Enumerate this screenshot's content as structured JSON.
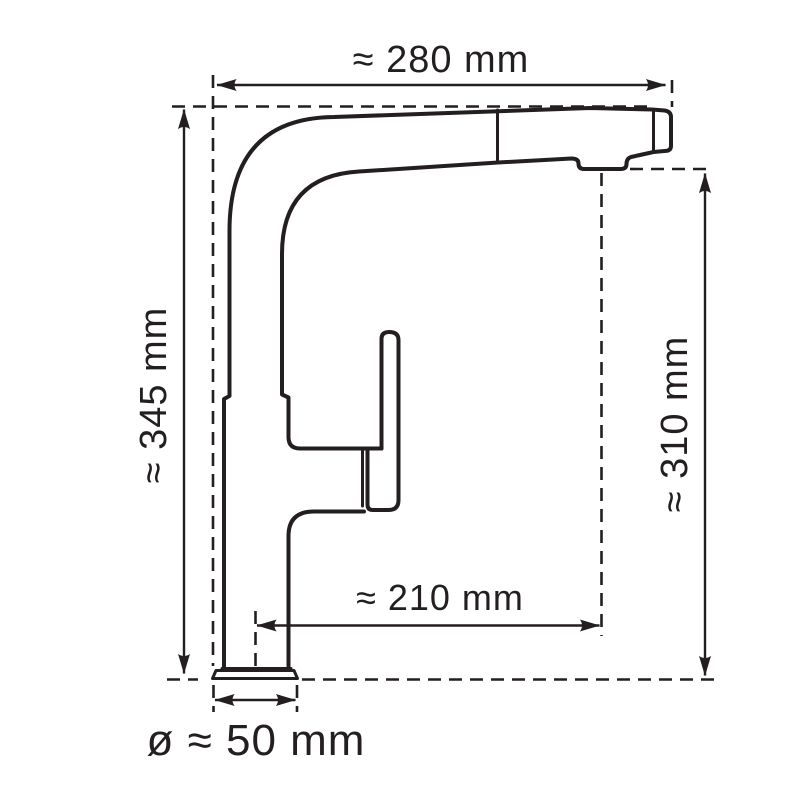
{
  "page": {
    "background": "#ffffff"
  },
  "diagram": {
    "type": "technical-dimension-drawing",
    "subject": "pull-out-kitchen-faucet-side-view",
    "line_color": "#231f20",
    "dimensions": {
      "top": "≈ 280 mm",
      "left": "≈ 345 mm",
      "right": "≈ 310 mm",
      "middle": "≈ 210 mm",
      "bottom": "ø ≈ 50 mm"
    }
  }
}
